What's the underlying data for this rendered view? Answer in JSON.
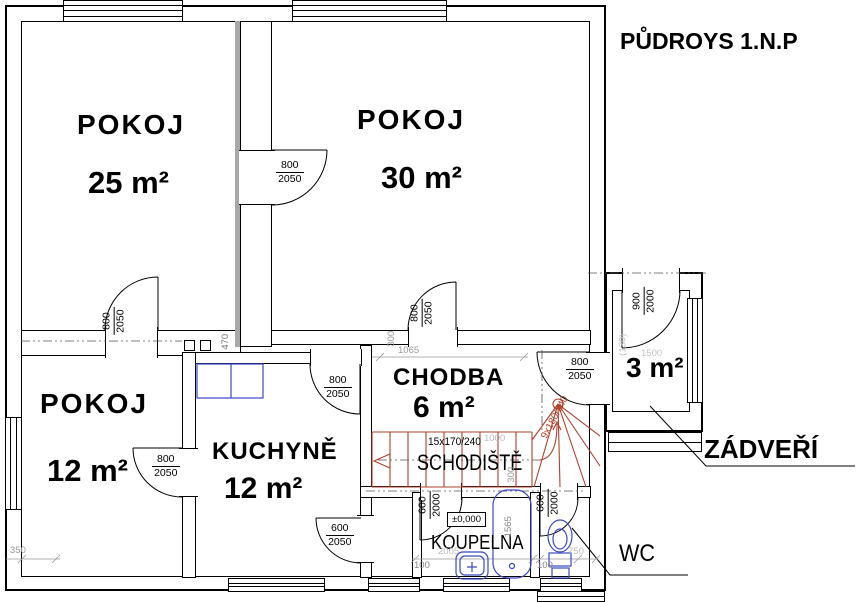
{
  "title": "PŮDROYS 1.N.P",
  "colors": {
    "wall": "#000000",
    "wall_axis_gray": "#a8a8a8",
    "stair_red": "#b0402c",
    "fixture_blue": "#3a49c0",
    "dim_gray": "#999999"
  },
  "rooms": {
    "pokoj25": {
      "name": "POKOJ",
      "area": "25 m²"
    },
    "pokoj30": {
      "name": "POKOJ",
      "area": "30 m²"
    },
    "pokoj12": {
      "name": "POKOJ",
      "area": "12 m²"
    },
    "kuchyne": {
      "name": "KUCHYNĚ",
      "area": "12 m²"
    },
    "chodba": {
      "name": "CHODBA",
      "area": "6 m²"
    },
    "zadveri": {
      "name": "ZÁDVEŘÍ",
      "area": "3 m²"
    },
    "schodiste": {
      "name": "SCHODIŠTĚ"
    },
    "koupelna": {
      "name": "KOUPELNA"
    },
    "wc": {
      "name": "WC"
    }
  },
  "doors": {
    "p25_p30": {
      "w": "800",
      "h": "2050"
    },
    "p25_p12": {
      "w": "800",
      "h": "2050"
    },
    "p30_chodba": {
      "w": "800",
      "h": "2050"
    },
    "kuchyne_chodba": {
      "w": "800",
      "h": "2050"
    },
    "p12_kuchyne": {
      "w": "800",
      "h": "2050"
    },
    "kuchyne_spiz": {
      "w": "600",
      "h": "2050"
    },
    "chodba_zadveri": {
      "w": "800",
      "h": "2050"
    },
    "zadveri_entry": {
      "w": "900",
      "h": "2000"
    },
    "koupelna": {
      "w": "600",
      "h": "2000"
    },
    "wc": {
      "w": "600",
      "h": "2000"
    }
  },
  "stairs": {
    "main": "15x170/240",
    "winder": "9x180/240"
  },
  "level_mark": "±0,000",
  "dims": {
    "d470": "470",
    "d1065": "1065",
    "d350": "350",
    "d300": "300",
    "d1000": "1000",
    "d300b": "300",
    "d1565": "1565",
    "d2005": "2005",
    "d750": "750",
    "d100a": "100",
    "d100b": "100",
    "d130": "(130)",
    "d1500": "1500"
  },
  "fixtures": {
    "bathtub": "bathtub",
    "sink": "sink",
    "toilet": "toilet",
    "kitchen_counter": "kitchen-counter",
    "chimney": "chimney-flues"
  }
}
